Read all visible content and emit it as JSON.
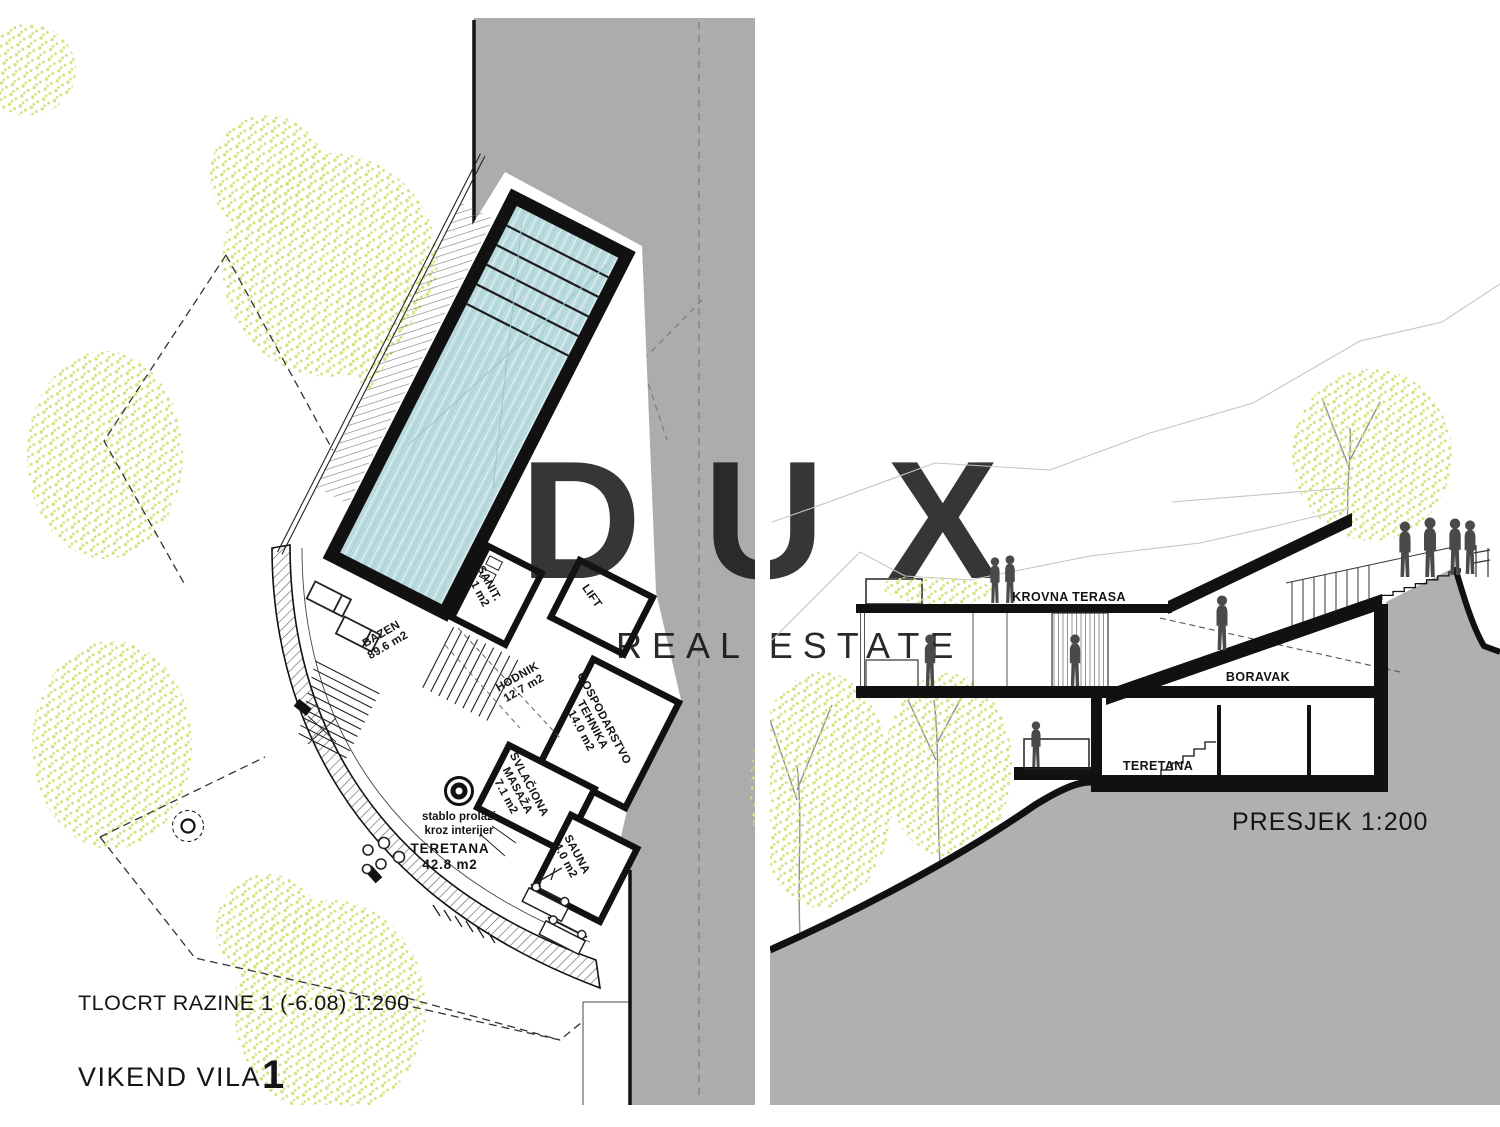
{
  "watermark": {
    "brand": "DUX",
    "tagline": "REAL ESTATE"
  },
  "plan": {
    "title": "TLOCRT RAZINE 1 (-6.08) 1:200",
    "project_name": "VIKEND VILA",
    "project_number": "1",
    "rooms": {
      "bazen": {
        "name": "BAZEN",
        "area": "89.6 m2"
      },
      "sanit": {
        "name": "SANIT.",
        "area": "3.1 m2"
      },
      "lift": {
        "name": "LIFT"
      },
      "hodnik": {
        "name": "HODNIK",
        "area": "12.7 m2"
      },
      "gospodarstvo": {
        "name": "GOSPODARSTVO",
        "name2": "TEHNIKA",
        "area": "14.0 m2"
      },
      "svlaciona": {
        "name": "SVLAČIONA",
        "name2": "MASAŽA",
        "area": "7.1 m2"
      },
      "sauna": {
        "name": "SAUNA",
        "area": "4.0 m2"
      },
      "teretana": {
        "name": "TERETANA",
        "area": "42.8 m2"
      }
    },
    "note_line1": "stablo prolazi",
    "note_line2": "kroz interijer"
  },
  "section": {
    "title": "PRESJEK 1:200",
    "labels": {
      "krovna_terasa": "KROVNA TERASA",
      "boravak": "BORAVAK",
      "teretana": "TERETANA"
    }
  },
  "colors": {
    "water": "#b9dade",
    "hill_gray": "#b0b0b0",
    "band_gray": "#acacac",
    "speckle": "#d9e07f",
    "silhouette": "#4a4a4a",
    "watermark": "#ececec",
    "ink": "#111111"
  }
}
